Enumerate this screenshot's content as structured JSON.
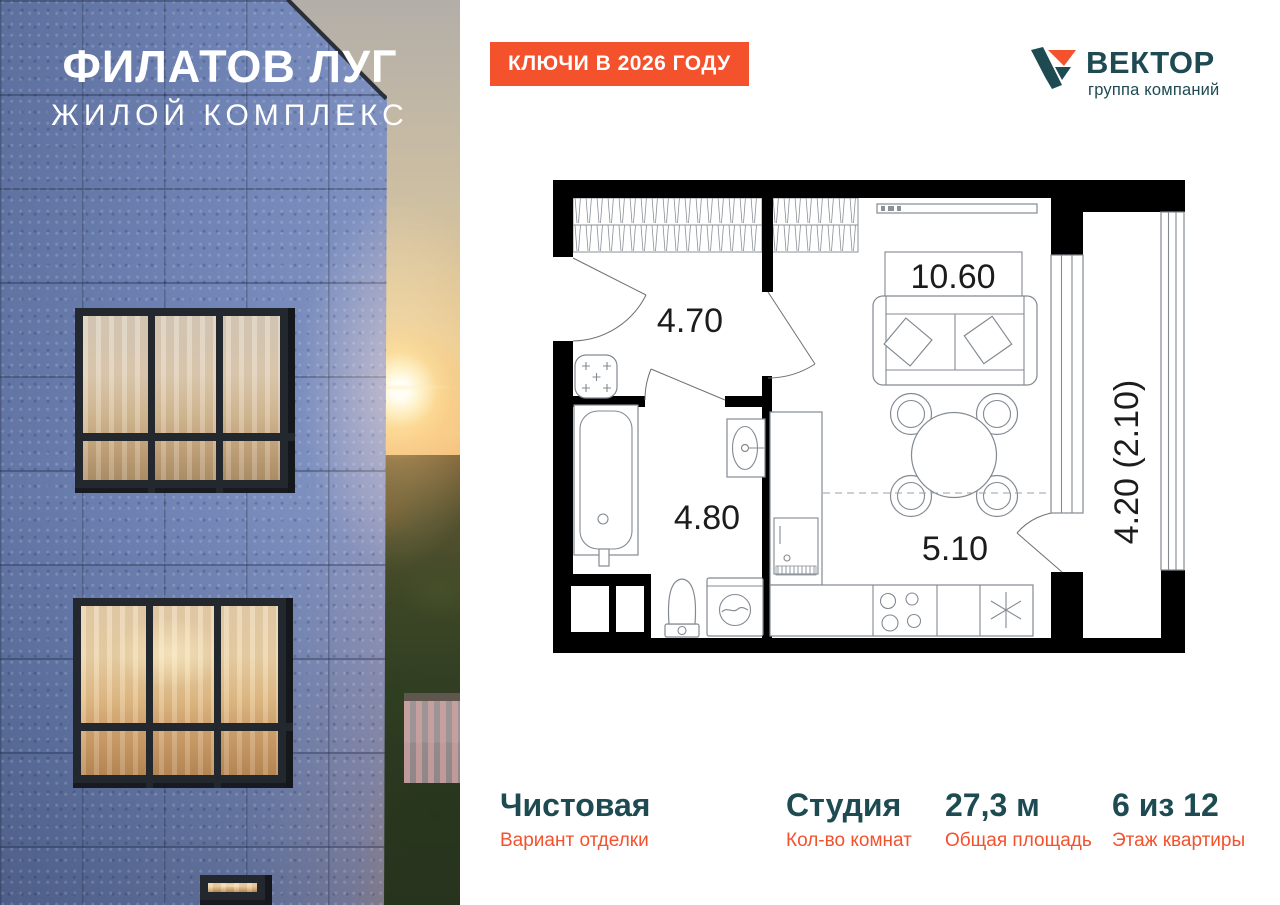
{
  "colors": {
    "accent_orange": "#F4512D",
    "brand_teal": "#1E4A52",
    "facade_blue": "#7186B9",
    "wall_black": "#000000",
    "plan_outline": "#838A92"
  },
  "hero": {
    "project_title": "ФИЛАТОВ ЛУГ",
    "project_subtitle": "ЖИЛОЙ КОМПЛЕКС"
  },
  "badge": {
    "text": "КЛЮЧИ В 2026 ГОДУ"
  },
  "developer": {
    "name": "ВЕКТОР",
    "tagline": "группа компаний"
  },
  "floor_plan": {
    "rooms": [
      {
        "id": "hallway",
        "area": "4.70"
      },
      {
        "id": "living-room",
        "area": "10.60"
      },
      {
        "id": "bathroom",
        "area": "4.80"
      },
      {
        "id": "kitchen",
        "area": "5.10"
      },
      {
        "id": "balcony",
        "area": "4.20 (2.10)"
      }
    ]
  },
  "details": [
    {
      "value": "Чистовая",
      "label": "Вариант отделки"
    },
    {
      "value": "Студия",
      "label": "Кол-во комнат"
    },
    {
      "value": "27,3 м",
      "label": "Общая площадь"
    },
    {
      "value": "6 из 12",
      "label": "Этаж квартиры"
    }
  ]
}
